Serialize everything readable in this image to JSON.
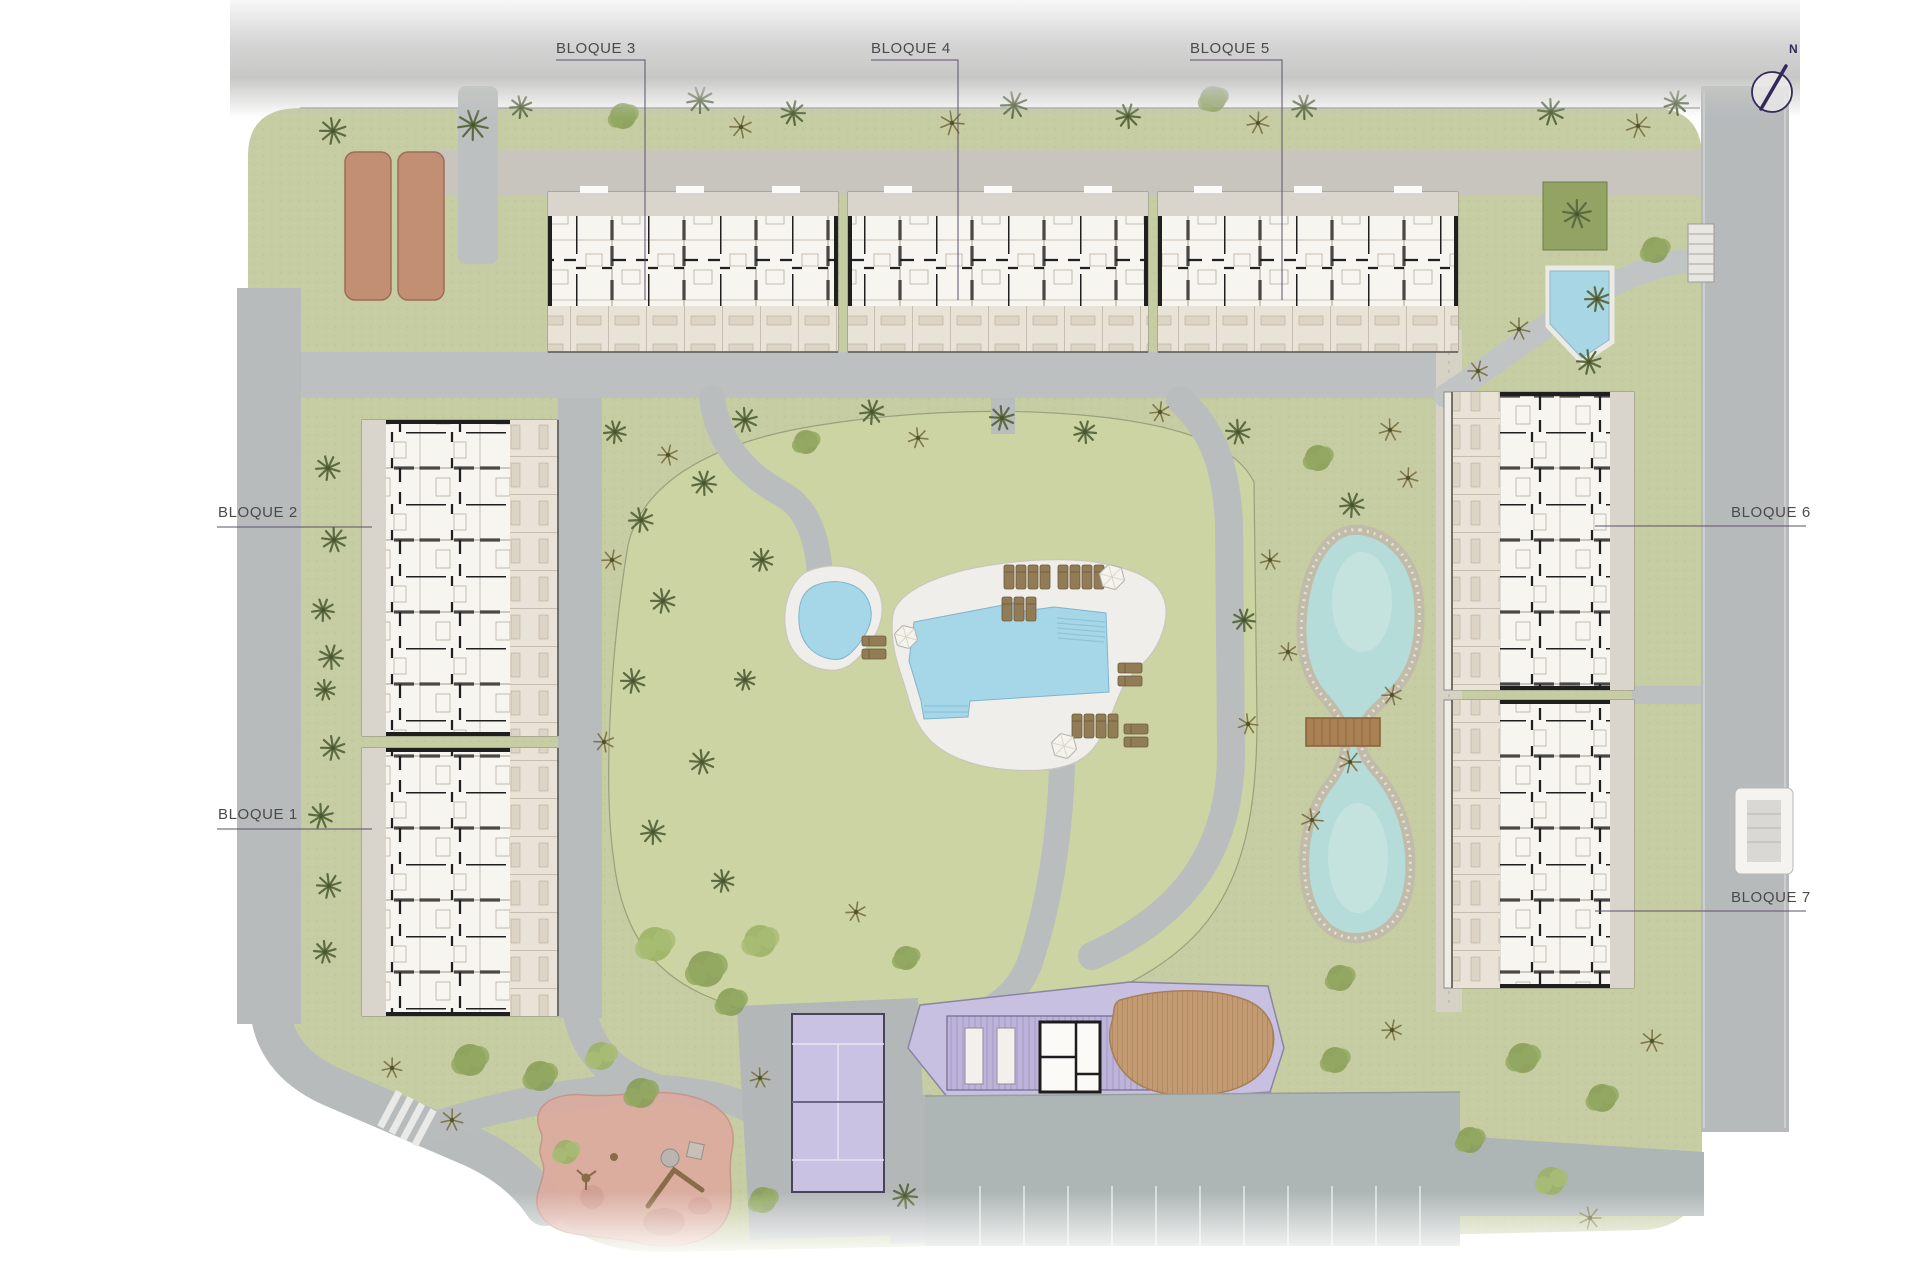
{
  "meta": {
    "type": "residential-masterplan-siteplan"
  },
  "labels": {
    "b1": "BLOQUE 1",
    "b2": "BLOQUE 2",
    "b3": "BLOQUE 3",
    "b4": "BLOQUE 4",
    "b5": "BLOQUE 5",
    "b6": "BLOQUE 6",
    "b7": "BLOQUE 7"
  },
  "north": {
    "label": "N"
  },
  "colors": {
    "grass": "#c6cda2",
    "grass_mound": "#ccd4a3",
    "path_gray": "#b8bcbd",
    "gravel": "#d6d2c6",
    "pool_water": "#a6d7e8",
    "pond_water": "#b5dcd8",
    "pool_deck": "#efeeea",
    "building_plan": "#f7f5f0",
    "terrace": "#e9e3d7",
    "wall_black": "#1f1f1f",
    "court_purple": "#cac2e3",
    "community_purple": "#c8c0e1",
    "wood_deck": "#c39a71",
    "parking_gray": "#aeb6b5",
    "playground_pink": "#dcab9f",
    "canopy_terracotta": "#c28f74",
    "label_text": "#4a4a4a",
    "leader_line": "#5d4f6b",
    "north_arrow": "#34285c"
  },
  "scene": {
    "vegetation": [
      {
        "t": "p",
        "x": 333,
        "y": 131,
        "s": 13
      },
      {
        "t": "p",
        "x": 473,
        "y": 125,
        "s": 15
      },
      {
        "t": "p",
        "x": 521,
        "y": 107,
        "s": 11
      },
      {
        "t": "b",
        "x": 623,
        "y": 116,
        "s": 13
      },
      {
        "t": "p",
        "x": 700,
        "y": 100,
        "s": 13
      },
      {
        "t": "s",
        "x": 741,
        "y": 127,
        "s": 11
      },
      {
        "t": "p",
        "x": 793,
        "y": 113,
        "s": 12
      },
      {
        "t": "s",
        "x": 952,
        "y": 123,
        "s": 12
      },
      {
        "t": "p",
        "x": 1014,
        "y": 105,
        "s": 13
      },
      {
        "t": "p",
        "x": 1128,
        "y": 116,
        "s": 12
      },
      {
        "t": "b",
        "x": 1213,
        "y": 99,
        "s": 13
      },
      {
        "t": "s",
        "x": 1258,
        "y": 123,
        "s": 11
      },
      {
        "t": "p",
        "x": 1304,
        "y": 107,
        "s": 12
      },
      {
        "t": "p",
        "x": 1551,
        "y": 112,
        "s": 13
      },
      {
        "t": "s",
        "x": 1638,
        "y": 126,
        "s": 12
      },
      {
        "t": "p",
        "x": 1676,
        "y": 103,
        "s": 12
      },
      {
        "t": "p",
        "x": 1577,
        "y": 214,
        "s": 14
      },
      {
        "t": "p",
        "x": 1597,
        "y": 299,
        "s": 12
      },
      {
        "t": "s",
        "x": 1519,
        "y": 329,
        "s": 11
      },
      {
        "t": "p",
        "x": 1589,
        "y": 362,
        "s": 12
      },
      {
        "t": "b",
        "x": 1655,
        "y": 250,
        "s": 13
      },
      {
        "t": "s",
        "x": 1478,
        "y": 371,
        "s": 10
      },
      {
        "t": "p",
        "x": 328,
        "y": 468,
        "s": 12
      },
      {
        "t": "p",
        "x": 334,
        "y": 540,
        "s": 12
      },
      {
        "t": "p",
        "x": 323,
        "y": 610,
        "s": 11
      },
      {
        "t": "p",
        "x": 331,
        "y": 657,
        "s": 12
      },
      {
        "t": "p",
        "x": 325,
        "y": 690,
        "s": 10
      },
      {
        "t": "p",
        "x": 333,
        "y": 748,
        "s": 12
      },
      {
        "t": "p",
        "x": 321,
        "y": 816,
        "s": 12
      },
      {
        "t": "p",
        "x": 329,
        "y": 886,
        "s": 12
      },
      {
        "t": "p",
        "x": 325,
        "y": 952,
        "s": 11
      },
      {
        "t": "p",
        "x": 641,
        "y": 520,
        "s": 12
      },
      {
        "t": "p",
        "x": 704,
        "y": 483,
        "s": 12
      },
      {
        "t": "p",
        "x": 663,
        "y": 601,
        "s": 12
      },
      {
        "t": "p",
        "x": 633,
        "y": 681,
        "s": 12
      },
      {
        "t": "p",
        "x": 702,
        "y": 762,
        "s": 12
      },
      {
        "t": "p",
        "x": 653,
        "y": 832,
        "s": 12
      },
      {
        "t": "p",
        "x": 723,
        "y": 881,
        "s": 11
      },
      {
        "t": "s",
        "x": 612,
        "y": 560,
        "s": 10
      },
      {
        "t": "s",
        "x": 604,
        "y": 742,
        "s": 10
      },
      {
        "t": "p",
        "x": 762,
        "y": 560,
        "s": 11
      },
      {
        "t": "p",
        "x": 745,
        "y": 680,
        "s": 10
      },
      {
        "t": "p",
        "x": 615,
        "y": 432,
        "s": 11
      },
      {
        "t": "s",
        "x": 668,
        "y": 455,
        "s": 10
      },
      {
        "t": "p",
        "x": 745,
        "y": 420,
        "s": 12
      },
      {
        "t": "b",
        "x": 806,
        "y": 442,
        "s": 12
      },
      {
        "t": "p",
        "x": 872,
        "y": 412,
        "s": 12
      },
      {
        "t": "s",
        "x": 918,
        "y": 438,
        "s": 10
      },
      {
        "t": "p",
        "x": 1002,
        "y": 418,
        "s": 12
      },
      {
        "t": "p",
        "x": 1085,
        "y": 432,
        "s": 11
      },
      {
        "t": "s",
        "x": 1160,
        "y": 412,
        "s": 10
      },
      {
        "t": "p",
        "x": 1238,
        "y": 432,
        "s": 12
      },
      {
        "t": "b",
        "x": 1318,
        "y": 458,
        "s": 13
      },
      {
        "t": "s",
        "x": 1390,
        "y": 430,
        "s": 11
      },
      {
        "t": "p",
        "x": 1352,
        "y": 505,
        "s": 12
      },
      {
        "t": "s",
        "x": 1408,
        "y": 478,
        "s": 10
      },
      {
        "t": "s",
        "x": 1392,
        "y": 695,
        "s": 10
      },
      {
        "t": "s",
        "x": 1350,
        "y": 762,
        "s": 11
      },
      {
        "t": "s",
        "x": 1312,
        "y": 820,
        "s": 11
      },
      {
        "t": "s",
        "x": 1288,
        "y": 652,
        "s": 9
      },
      {
        "t": "b",
        "x": 1340,
        "y": 978,
        "s": 13
      },
      {
        "t": "s",
        "x": 1270,
        "y": 560,
        "s": 10
      },
      {
        "t": "p",
        "x": 1244,
        "y": 620,
        "s": 11
      },
      {
        "t": "s",
        "x": 1248,
        "y": 724,
        "s": 10
      },
      {
        "t": "g",
        "x": 655,
        "y": 944,
        "s": 17
      },
      {
        "t": "b",
        "x": 706,
        "y": 969,
        "s": 18
      },
      {
        "t": "g",
        "x": 760,
        "y": 941,
        "s": 16
      },
      {
        "t": "b",
        "x": 731,
        "y": 1002,
        "s": 14
      },
      {
        "t": "s",
        "x": 856,
        "y": 912,
        "s": 10
      },
      {
        "t": "b",
        "x": 906,
        "y": 958,
        "s": 12
      },
      {
        "t": "b",
        "x": 470,
        "y": 1060,
        "s": 16
      },
      {
        "t": "b",
        "x": 540,
        "y": 1076,
        "s": 15
      },
      {
        "t": "g",
        "x": 601,
        "y": 1056,
        "s": 14
      },
      {
        "t": "b",
        "x": 641,
        "y": 1093,
        "s": 15
      },
      {
        "t": "s",
        "x": 452,
        "y": 1120,
        "s": 11
      },
      {
        "t": "s",
        "x": 392,
        "y": 1068,
        "s": 10
      },
      {
        "t": "g",
        "x": 566,
        "y": 1152,
        "s": 12
      },
      {
        "t": "b",
        "x": 763,
        "y": 1200,
        "s": 13
      },
      {
        "t": "p",
        "x": 905,
        "y": 1196,
        "s": 12
      },
      {
        "t": "s",
        "x": 760,
        "y": 1078,
        "s": 10
      },
      {
        "t": "b",
        "x": 1523,
        "y": 1058,
        "s": 15
      },
      {
        "t": "b",
        "x": 1602,
        "y": 1098,
        "s": 14
      },
      {
        "t": "g",
        "x": 1551,
        "y": 1181,
        "s": 14
      },
      {
        "t": "s",
        "x": 1652,
        "y": 1041,
        "s": 11
      },
      {
        "t": "b",
        "x": 1470,
        "y": 1140,
        "s": 13
      },
      {
        "t": "s",
        "x": 1590,
        "y": 1218,
        "s": 11
      },
      {
        "t": "b",
        "x": 1335,
        "y": 1060,
        "s": 13
      },
      {
        "t": "s",
        "x": 1392,
        "y": 1030,
        "s": 10
      }
    ],
    "pool_furniture": {
      "loungers": [
        {
          "x": 1004,
          "y": 565,
          "o": "v"
        },
        {
          "x": 1016,
          "y": 565,
          "o": "v"
        },
        {
          "x": 1028,
          "y": 565,
          "o": "v"
        },
        {
          "x": 1040,
          "y": 565,
          "o": "v"
        },
        {
          "x": 1058,
          "y": 565,
          "o": "v"
        },
        {
          "x": 1070,
          "y": 565,
          "o": "v"
        },
        {
          "x": 1082,
          "y": 565,
          "o": "v"
        },
        {
          "x": 1094,
          "y": 565,
          "o": "v"
        },
        {
          "x": 1002,
          "y": 597,
          "o": "v"
        },
        {
          "x": 1014,
          "y": 597,
          "o": "v"
        },
        {
          "x": 1026,
          "y": 597,
          "o": "v"
        },
        {
          "x": 1118,
          "y": 663,
          "o": "h"
        },
        {
          "x": 1118,
          "y": 676,
          "o": "h"
        },
        {
          "x": 1072,
          "y": 714,
          "o": "v"
        },
        {
          "x": 1084,
          "y": 714,
          "o": "v"
        },
        {
          "x": 1096,
          "y": 714,
          "o": "v"
        },
        {
          "x": 1108,
          "y": 714,
          "o": "v"
        },
        {
          "x": 1124,
          "y": 724,
          "o": "h"
        },
        {
          "x": 1124,
          "y": 737,
          "o": "h"
        },
        {
          "x": 862,
          "y": 636,
          "o": "h"
        },
        {
          "x": 862,
          "y": 649,
          "o": "h"
        }
      ],
      "umbrellas": [
        {
          "x": 1112,
          "y": 577,
          "r": 13
        },
        {
          "x": 906,
          "y": 637,
          "r": 12
        },
        {
          "x": 1064,
          "y": 746,
          "r": 13
        }
      ]
    }
  }
}
